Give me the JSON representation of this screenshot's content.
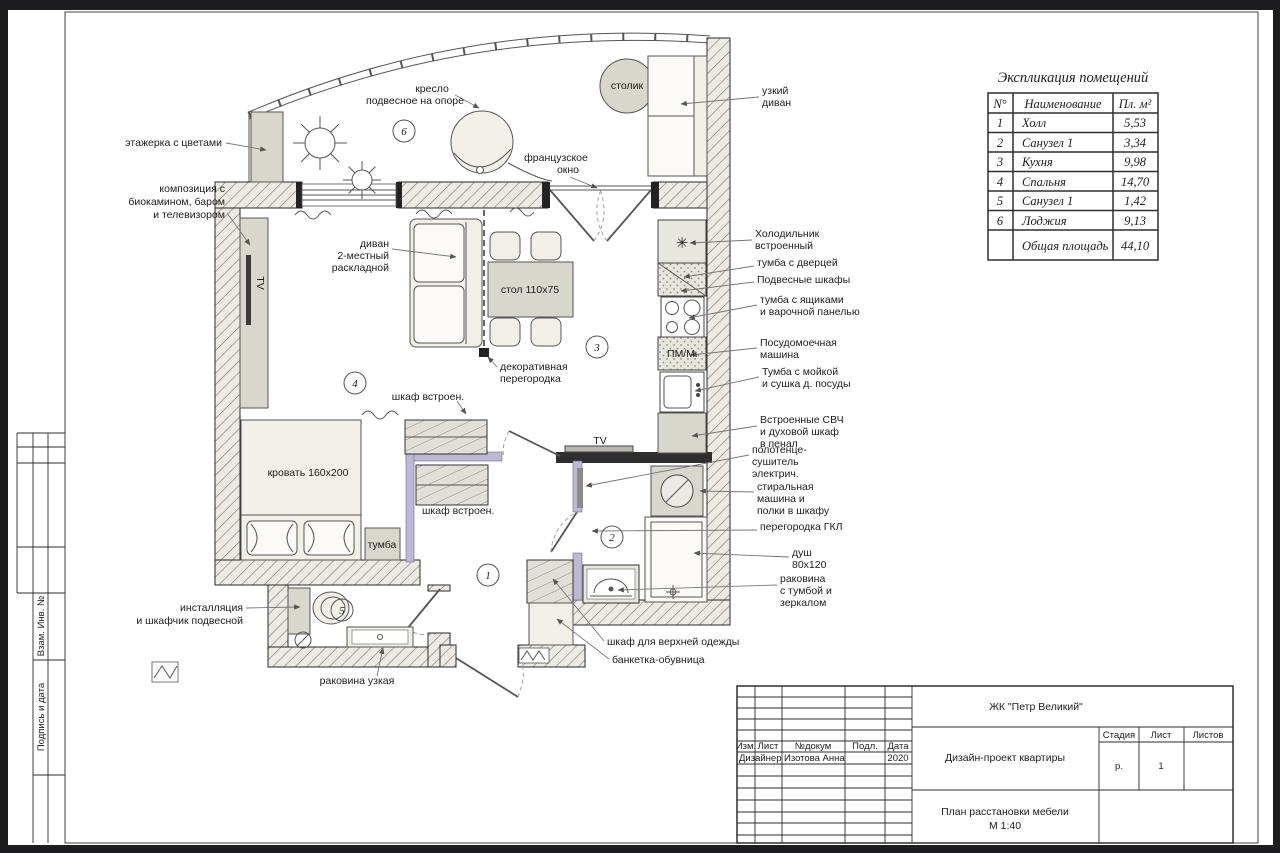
{
  "colors": {
    "paper": "#ffffff",
    "border": "#1d1d1f",
    "line": "#2a2a2a",
    "partition_gkl": "#bdb9d4",
    "furniture": "#f2efe6",
    "cabinet_gray": "#d9d6cc"
  },
  "margin": {
    "vzam": "Взам. Инв. №",
    "podpis": "Подпись и дата"
  },
  "schedule": {
    "title": "Экспликация помещений",
    "headers": {
      "num": "N°",
      "name": "Наименование",
      "area": "Пл. м²"
    },
    "rows": [
      {
        "num": "1",
        "name": "Холл",
        "area": "5,53"
      },
      {
        "num": "2",
        "name": "Санузел 1",
        "area": "3,34"
      },
      {
        "num": "3",
        "name": "Кухня",
        "area": "9,98"
      },
      {
        "num": "4",
        "name": "Спальня",
        "area": "14,70"
      },
      {
        "num": "5",
        "name": "Санузел 1",
        "area": "1,42"
      },
      {
        "num": "6",
        "name": "Лоджия",
        "area": "9,13"
      }
    ],
    "total": {
      "name": "Общая площадь",
      "area": "44,10"
    }
  },
  "titleblock": {
    "project": "ЖК \"Петр Великий\"",
    "doc_title": "Дизайн-проект квартиры",
    "sheet_title": "План расстановки мебели",
    "scale": "М 1:40",
    "cols": {
      "izm": "Изм.",
      "list": "Лист",
      "dokum": "№докум",
      "podp": "Подл.",
      "data": "Дата"
    },
    "row": {
      "role": "Дизайнер",
      "name": "Изотова Анна",
      "year": "2020"
    },
    "stage": {
      "stadia": "Стадия",
      "list": "Лист",
      "listov": "Листов"
    },
    "values": {
      "stadia": "р.",
      "list": "1",
      "listov": ""
    }
  },
  "rooms": {
    "hall": "1",
    "bath": "2",
    "kitchen": "3",
    "bedroom": "4",
    "wc": "5",
    "loggia": "6"
  },
  "icons": {
    "snowflake": "✳"
  },
  "labels": {
    "etazherka": "этажерка с цветами",
    "komp1": "композиция с",
    "komp2": "биокамином, баром",
    "komp3": "и телевизором",
    "kreslo1": "кресло",
    "kreslo2": "подвесное на опоре",
    "stolik": "столик",
    "uzkiy1": "узкий",
    "uzkiy2": "диван",
    "franz1": "французское",
    "franz2": "окно",
    "holod1": "Холодильник",
    "holod2": "встроенный",
    "tumba_dv": "тумба с дверцей",
    "podves": "Подвесные шкафы",
    "tumba_ya1": "тумба с ящиками",
    "tumba_ya2": "и варочной панелью",
    "posud1": "Посудомоечная",
    "posud2": "машина",
    "moyka1": "Тумба с мойкой",
    "moyka2": "и сушка д. посуды",
    "svch1": "Встроенные СВЧ",
    "svch2": "и духовой шкаф",
    "svch3": "в пенал",
    "polot1": "полотенце-",
    "polot2": "сушитель",
    "polot3": "электрич.",
    "stir1": "стиральная",
    "stir2": "машина и",
    "stir3": "полки в шкафу",
    "gkl": "перегородка ГКЛ",
    "dush1": "душ",
    "dush2": "80x120",
    "rakov1": "раковина",
    "rakov2": "с тумбой и",
    "rakov3": "зеркалом",
    "divan1": "диван",
    "divan2": "2-местный",
    "divan3": "раскладной",
    "stol": "стол 110x75",
    "dekor1": "декоративная",
    "dekor2": "перегородка",
    "shkaf_top": "шкаф встроен.",
    "shkaf_bot": "шкаф встроен.",
    "krovat": "кровать 160x200",
    "tumba": "тумба",
    "pmm": "ПМ/М",
    "tv_liv": "TV",
    "tv_bath": "TV",
    "instal1": "инсталляция",
    "instal2": "и шкафчик подвесной",
    "rak_uz": "раковина узкая",
    "shkaf_verh": "шкаф для верхней одежды",
    "banketka": "банкетка-обувница"
  }
}
